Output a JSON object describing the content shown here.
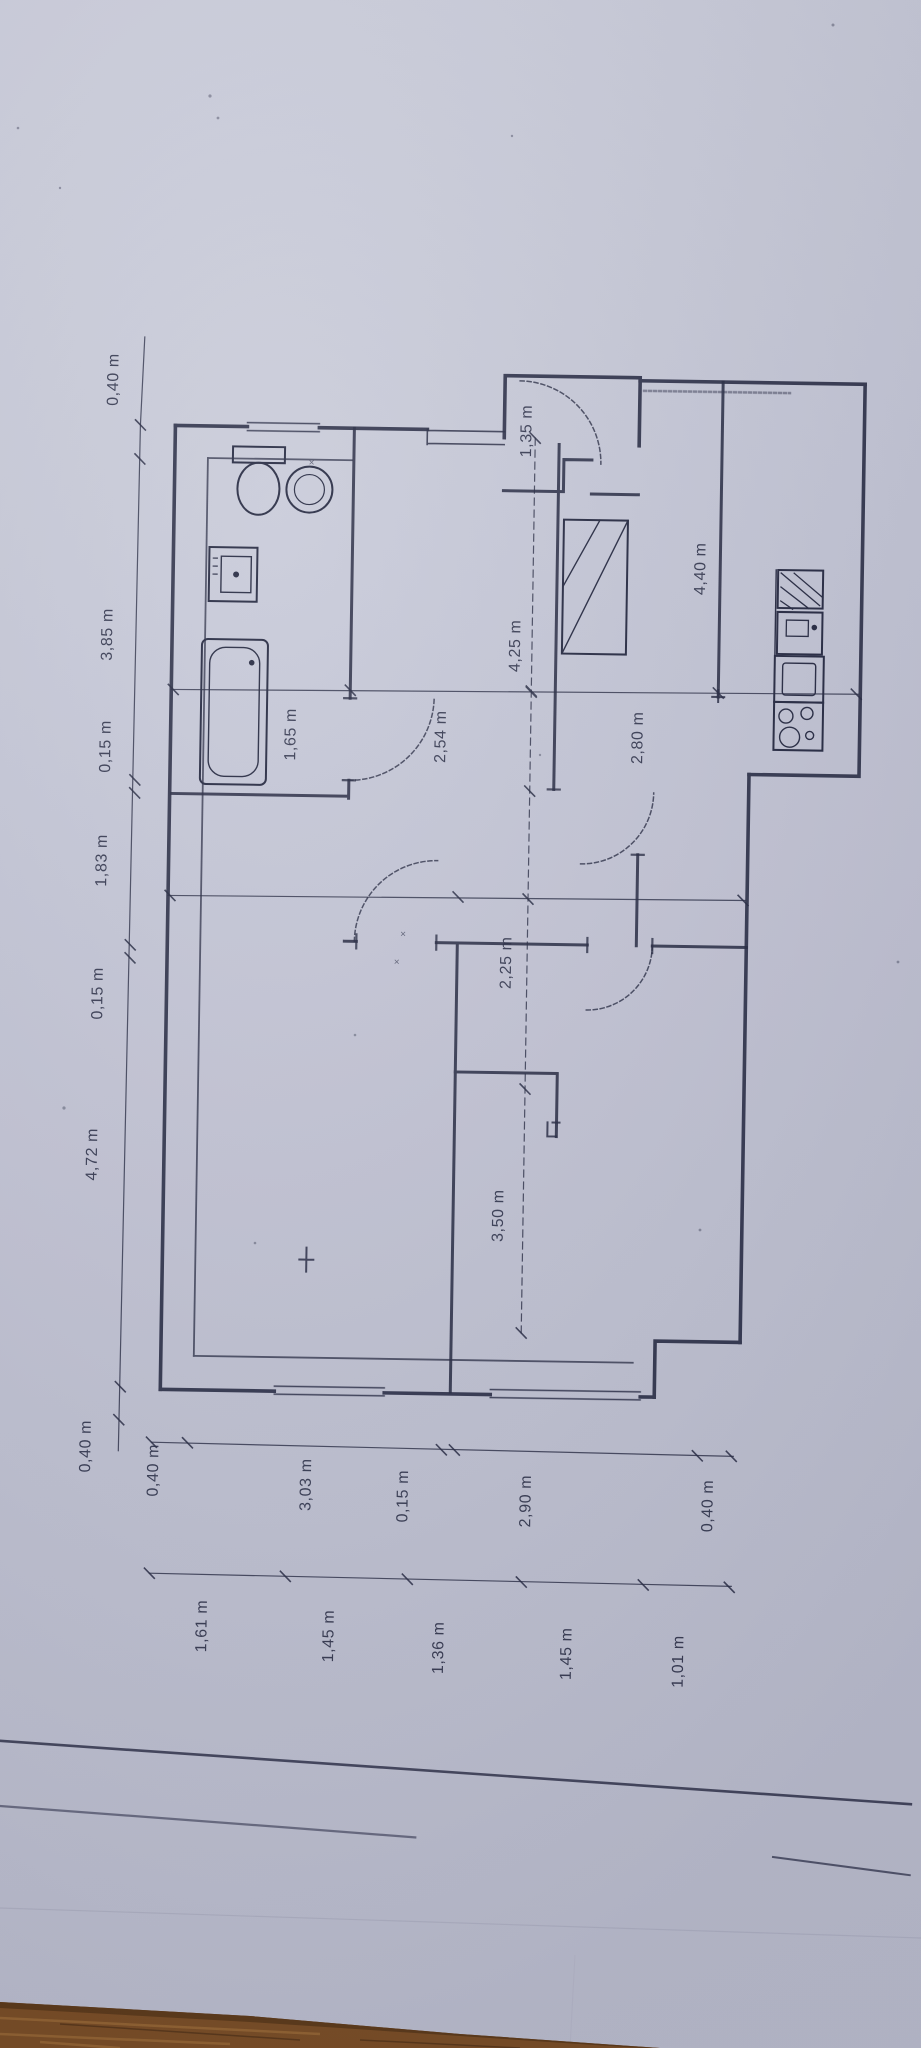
{
  "photo": {
    "paper_color": "#c6c8d7",
    "ink_color": "#23273f",
    "wood_color": "#7c4e23",
    "wood_grain_color": "#9c6b33",
    "unit": "m"
  },
  "plan": {
    "left_chain": [
      "0,40 m",
      "3,85 m",
      "0,15 m",
      "1,83 m",
      "0,15 m",
      "4,72 m",
      "0,40 m"
    ],
    "bottom_chain_outer": [
      "0,40 m",
      "3,03 m",
      "0,15 m",
      "2,90 m",
      "0,40 m"
    ],
    "bottom_chain_inner": [
      "1,61 m",
      "1,45 m",
      "1,36 m",
      "1,45 m",
      "1,01 m"
    ],
    "interior": {
      "entry_width": "1,35 m",
      "bathroom_width": "1,65 m",
      "middle_room_width": "2,54 m",
      "middle_room_length": "4,25 m",
      "living_width": "2,80 m",
      "kitchen_length": "4,40 m",
      "hall_length": "2,25 m",
      "bedroom_length": "3,50 m"
    },
    "marks": {
      "door_cross": "×"
    }
  }
}
